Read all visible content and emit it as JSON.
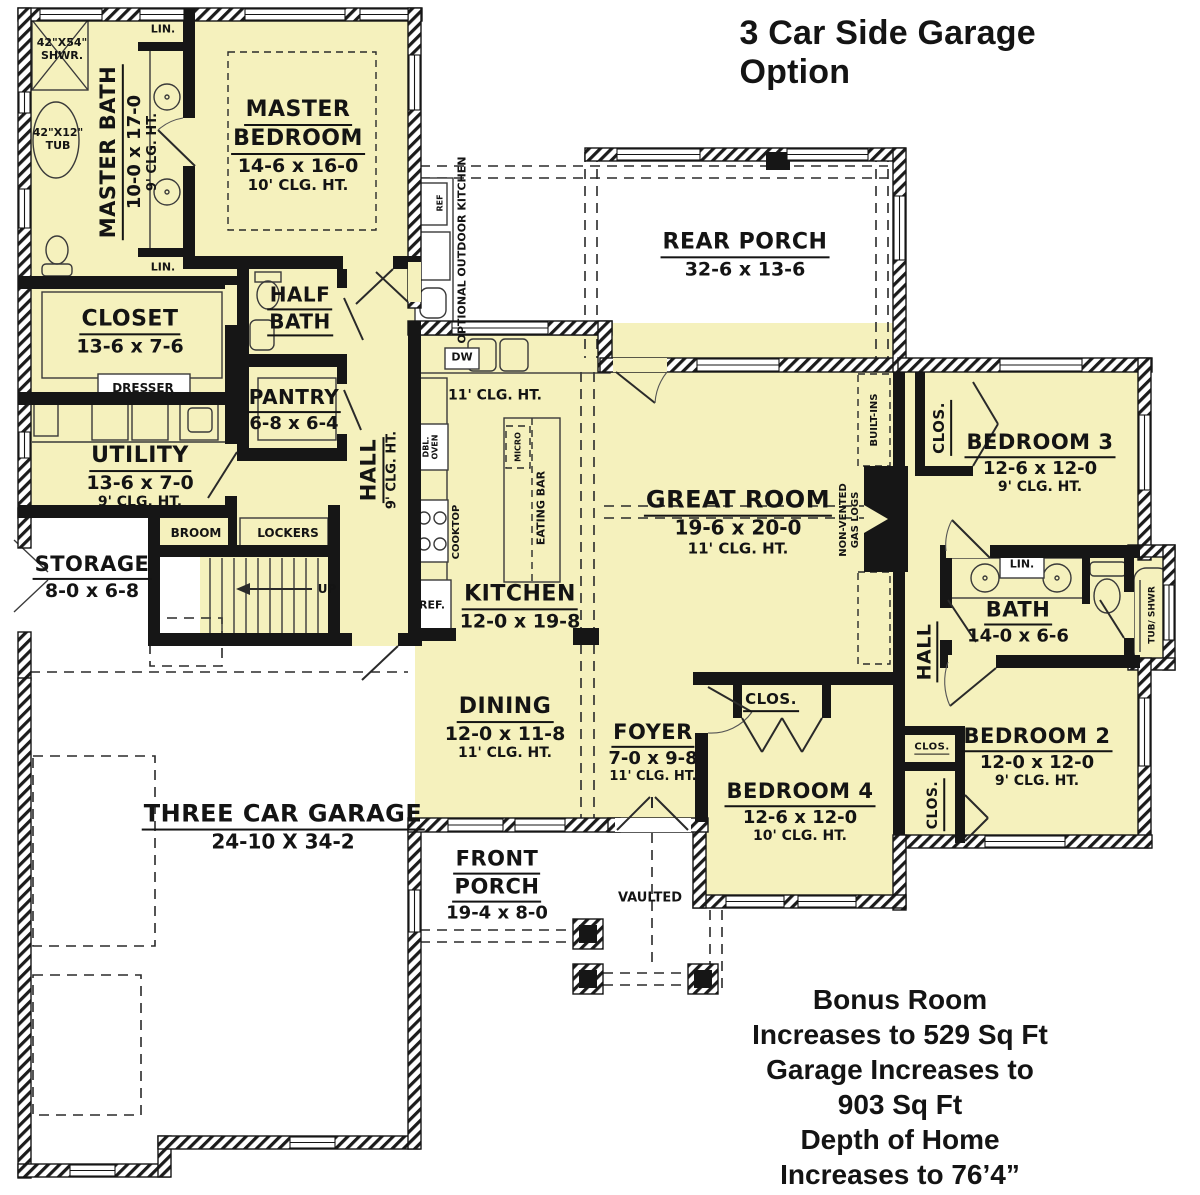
{
  "title": "3 Car Side Garage Option",
  "notes": {
    "line1": "Bonus Room Increases to 529 Sq Ft",
    "line2": "Garage Increases to 903 Sq Ft",
    "line3": "Depth of Home Increases to 76’4”"
  },
  "colors": {
    "room_fill": "#F5F1BD",
    "wall": "#161616",
    "paper": "#FFFFFF",
    "text": "#141414"
  },
  "rooms": {
    "master_bedroom": {
      "name_line1": "MASTER",
      "name_line2": "BEDROOM",
      "dims": "14-6 x 16-0",
      "ceiling": "10' CLG. HT."
    },
    "master_bath": {
      "name": "MASTER BATH",
      "dims": "10-0 x 17-0",
      "ceiling": "9' CLG. HT."
    },
    "closet": {
      "name": "CLOSET",
      "dims": "13-6 x 7-6"
    },
    "half_bath": {
      "name_line1": "HALF",
      "name_line2": "BATH"
    },
    "pantry": {
      "name": "PANTRY",
      "dims": "6-8 x 6-4"
    },
    "utility": {
      "name": "UTILITY",
      "dims": "13-6 x 7-0",
      "ceiling": "9' CLG. HT."
    },
    "storage": {
      "name": "STORAGE",
      "dims": "8-0 x 6-8"
    },
    "hall_left": {
      "name": "HALL",
      "ceiling": "9' CLG. HT."
    },
    "kitchen": {
      "name": "KITCHEN",
      "dims": "12-0 x 19-8",
      "ceiling": "11' CLG. HT."
    },
    "dining": {
      "name": "DINING",
      "dims": "12-0 x 11-8",
      "ceiling": "11' CLG. HT."
    },
    "great_room": {
      "name": "GREAT ROOM",
      "dims": "19-6 x 20-0",
      "ceiling": "11' CLG. HT."
    },
    "foyer": {
      "name": "FOYER",
      "dims": "7-0 x 9-8",
      "ceiling": "11' CLG. HT."
    },
    "rear_porch": {
      "name": "REAR PORCH",
      "dims": "32-6 x 13-6"
    },
    "front_porch": {
      "name_line1": "FRONT",
      "name_line2": "PORCH",
      "dims": "19-4 x 8-0"
    },
    "garage": {
      "name": "THREE CAR GARAGE",
      "dims": "24-10 X 34-2"
    },
    "bedroom2": {
      "name": "BEDROOM 2",
      "dims": "12-0 x 12-0",
      "ceiling": "9' CLG. HT."
    },
    "bedroom3": {
      "name": "BEDROOM 3",
      "dims": "12-6 x 12-0",
      "ceiling": "9' CLG. HT."
    },
    "bedroom4": {
      "name": "BEDROOM 4",
      "dims": "12-6 x 12-0",
      "ceiling": "10' CLG. HT."
    },
    "bath": {
      "name": "BATH",
      "dims": "14-0 x 6-6"
    },
    "hall_right": {
      "name": "HALL"
    }
  },
  "fixtures": {
    "shower_line1": "42\"X54\"",
    "shower_line2": "SHWR.",
    "tub_line1": "42\"X12\"",
    "tub_line2": "TUB",
    "lin": "LIN.",
    "dresser": "DRESSER",
    "broom": "BROOM",
    "lockers": "LOCKERS",
    "up": "UP",
    "dw": "DW",
    "ref": "REF.",
    "ref_small": "REF",
    "dbl_oven_line1": "DBL.",
    "dbl_oven_line2": "OVEN",
    "cooktop": "COOKTOP",
    "micro": "MICRO",
    "eating_bar": "EATING BAR",
    "built_ins": "BUILT-INS",
    "gas_logs_line1": "NON-VENTED",
    "gas_logs_line2": "GAS LOGS",
    "optional_outdoor_kitchen": "OPTIONAL OUTDOOR KITCHEN",
    "tub_shwr": "TUB/ SHWR",
    "clos": "CLOS.",
    "vaulted": "VAULTED"
  }
}
